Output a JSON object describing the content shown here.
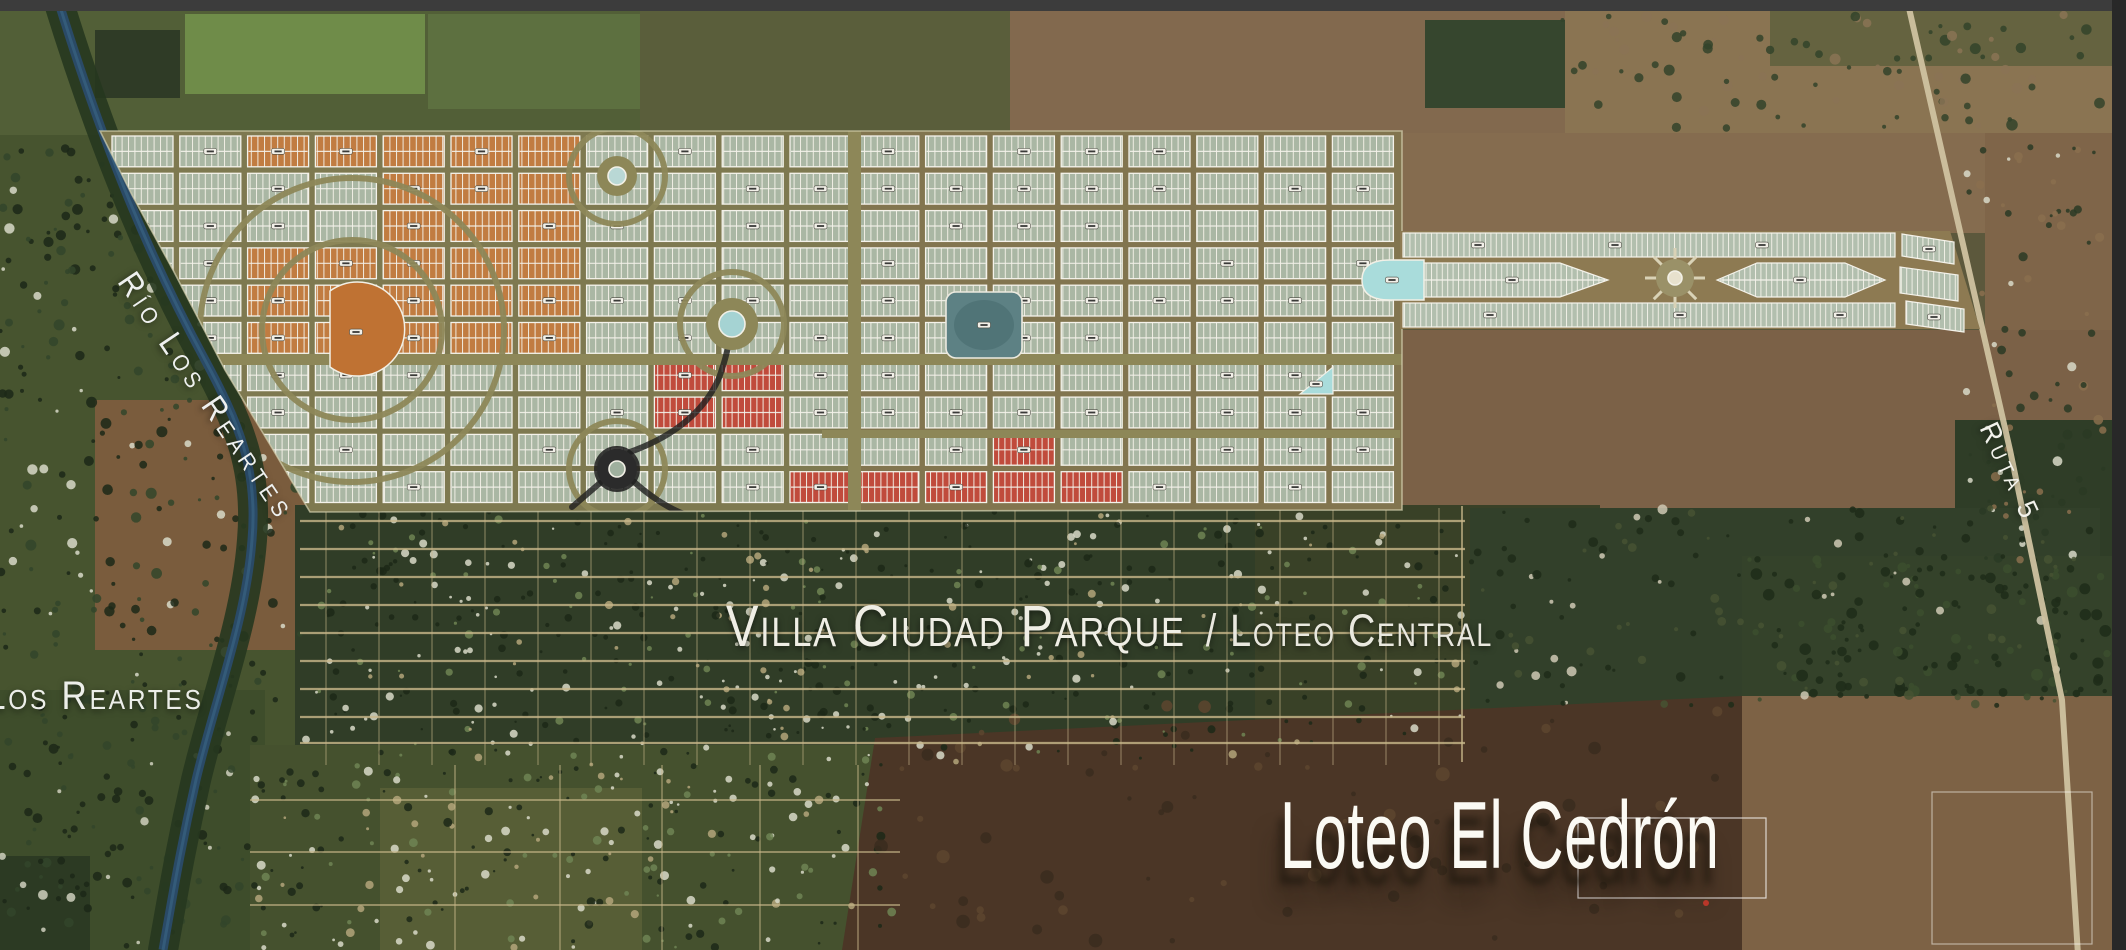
{
  "labels": {
    "villa_ciudad_parque": "Villa Ciudad Parque",
    "loteo_central_suffix": "/ Loteo Central",
    "loteo_el_cedron": "Loteo El Cedrón",
    "rio_los_reartes": "Río Los Reartes",
    "los_reartes": "Los Reartes",
    "ruta_5": "Ruta 5"
  },
  "map": {
    "width": 2126,
    "height": 950,
    "seed": 1337,
    "chrome": {
      "top_bar": {
        "h": 11,
        "fill": "#3c3c3c"
      },
      "right_bar": {
        "w": 14,
        "fill": "#282828"
      }
    },
    "fields": [
      {
        "t": "r",
        "x": 0,
        "y": 11,
        "w": 2126,
        "h": 939,
        "f": "#5c583c"
      },
      {
        "t": "r",
        "x": 0,
        "y": 11,
        "w": 660,
        "h": 124,
        "f": "#525f37"
      },
      {
        "t": "r",
        "x": 185,
        "y": 14,
        "w": 240,
        "h": 80,
        "f": "#6f8c49"
      },
      {
        "t": "r",
        "x": 428,
        "y": 14,
        "w": 215,
        "h": 95,
        "f": "#5d7040"
      },
      {
        "t": "r",
        "x": 95,
        "y": 30,
        "w": 85,
        "h": 68,
        "f": "#2f3b26"
      },
      {
        "t": "r",
        "x": 640,
        "y": 11,
        "w": 370,
        "h": 124,
        "f": "#5a5e3b"
      },
      {
        "t": "r",
        "x": 1010,
        "y": 11,
        "w": 560,
        "h": 124,
        "f": "#82694e"
      },
      {
        "t": "r",
        "x": 1425,
        "y": 20,
        "w": 140,
        "h": 88,
        "f": "#36462e"
      },
      {
        "t": "r",
        "x": 1565,
        "y": 11,
        "w": 547,
        "h": 124,
        "f": "#8a7452"
      },
      {
        "t": "r",
        "x": 1770,
        "y": 11,
        "w": 342,
        "h": 55,
        "f": "#555c39",
        "o": 0.7
      },
      {
        "t": "r",
        "x": 0,
        "y": 135,
        "w": 320,
        "h": 630,
        "f": "#47542f"
      },
      {
        "t": "r",
        "x": 95,
        "y": 400,
        "w": 235,
        "h": 250,
        "f": "#7a5c3d"
      },
      {
        "t": "r",
        "x": 0,
        "y": 690,
        "w": 265,
        "h": 260,
        "f": "#3e4d2b"
      },
      {
        "t": "r",
        "x": 1400,
        "y": 133,
        "w": 585,
        "h": 100,
        "f": "#856c4f"
      },
      {
        "t": "r",
        "x": 1985,
        "y": 133,
        "w": 127,
        "h": 430,
        "f": "#7f6549"
      },
      {
        "t": "r",
        "x": 1400,
        "y": 330,
        "w": 712,
        "h": 185,
        "f": "#7b6147"
      },
      {
        "t": "r",
        "x": 1955,
        "y": 420,
        "w": 157,
        "h": 345,
        "f": "#2f3d27"
      },
      {
        "t": "r",
        "x": 295,
        "y": 505,
        "w": 1175,
        "h": 262,
        "f": "#303d27"
      },
      {
        "t": "r",
        "x": 1255,
        "y": 505,
        "w": 345,
        "h": 258,
        "f": "#394127"
      },
      {
        "t": "r",
        "x": 1470,
        "y": 508,
        "w": 630,
        "h": 200,
        "f": "#32402a"
      },
      {
        "t": "r",
        "x": 250,
        "y": 745,
        "w": 680,
        "h": 205,
        "f": "#45512e"
      },
      {
        "t": "r",
        "x": 380,
        "y": 788,
        "w": 262,
        "h": 162,
        "f": "#575e36"
      },
      {
        "t": "p",
        "pts": "875,738 1742,696 1742,950 842,950",
        "f": "#4b3626"
      },
      {
        "t": "r",
        "x": 1742,
        "y": 690,
        "w": 370,
        "h": 260,
        "f": "#7d6245"
      },
      {
        "t": "r",
        "x": 1742,
        "y": 556,
        "w": 370,
        "h": 140,
        "f": "#34422a"
      },
      {
        "t": "r",
        "x": 0,
        "y": 856,
        "w": 90,
        "h": 94,
        "f": "#2c3a23"
      }
    ],
    "speck_groups": [
      {
        "x": 305,
        "y": 512,
        "w": 1160,
        "h": 250,
        "n": 540,
        "cols": [
          "#1c2817",
          "#d8d9c8",
          "#6f8453",
          "#b3a47a"
        ],
        "w8": [
          0.42,
          0.27,
          0.19,
          0.12
        ],
        "rmin": 1.2,
        "rmax": 4.2
      },
      {
        "x": 255,
        "y": 762,
        "w": 645,
        "h": 186,
        "n": 230,
        "cols": [
          "#1c2817",
          "#d8d9c8",
          "#6f8453",
          "#b3a47a"
        ],
        "w8": [
          0.4,
          0.25,
          0.2,
          0.15
        ],
        "rmin": 1.2,
        "rmax": 4.5
      },
      {
        "x": 0,
        "y": 140,
        "w": 300,
        "h": 560,
        "n": 260,
        "cols": [
          "#1c2817",
          "#33452a",
          "#d8d9c8"
        ],
        "w8": [
          0.5,
          0.35,
          0.15
        ],
        "rmin": 1.5,
        "rmax": 5.5
      },
      {
        "x": 0,
        "y": 700,
        "w": 260,
        "h": 248,
        "n": 120,
        "cols": [
          "#1c2817",
          "#33452a",
          "#cfd0bd"
        ],
        "w8": [
          0.5,
          0.35,
          0.15
        ],
        "rmin": 1.5,
        "rmax": 5
      },
      {
        "x": 1965,
        "y": 140,
        "w": 145,
        "h": 420,
        "n": 90,
        "cols": [
          "#2a3a24",
          "#8a6f4e",
          "#d8d9c8"
        ],
        "w8": [
          0.55,
          0.3,
          0.15
        ],
        "rmin": 1.5,
        "rmax": 5
      },
      {
        "x": 1745,
        "y": 555,
        "w": 365,
        "h": 145,
        "n": 110,
        "cols": [
          "#1e2c19",
          "#3c4d2e"
        ],
        "w8": [
          0.6,
          0.4
        ],
        "rmin": 2,
        "rmax": 6
      },
      {
        "x": 1470,
        "y": 508,
        "w": 630,
        "h": 200,
        "n": 160,
        "cols": [
          "#1e2c19",
          "#465233",
          "#cfc9b4"
        ],
        "w8": [
          0.5,
          0.35,
          0.15
        ],
        "rmin": 1.5,
        "rmax": 5
      },
      {
        "x": 1560,
        "y": 15,
        "w": 545,
        "h": 115,
        "n": 90,
        "cols": [
          "#33432a",
          "#8a7355"
        ],
        "w8": [
          0.6,
          0.4
        ],
        "rmin": 2,
        "rmax": 6
      },
      {
        "x": 875,
        "y": 700,
        "w": 860,
        "h": 245,
        "n": 70,
        "cols": [
          "#3a2b1e",
          "#5d452f"
        ],
        "w8": [
          0.55,
          0.45
        ],
        "rmin": 2,
        "rmax": 7
      }
    ],
    "river": {
      "path": "M58,0 C95,120 140,240 205,360 C240,425 258,470 252,540 C246,620 215,700 196,780 C180,850 172,900 163,950",
      "water": "#2a4a66",
      "bank": "#26371f"
    },
    "ruta5": {
      "path": "M1906,-5 L2010,450 L2062,700 L2078,955",
      "stroke": "#cfc2a0",
      "w": 6
    },
    "village": {
      "x": 300,
      "y": 508,
      "w": 1165,
      "h": 257,
      "road": "#c9b88a",
      "h_roads": [
        521,
        549,
        577,
        605,
        633,
        661,
        689,
        717,
        743
      ],
      "v_step": 53,
      "below": {
        "x": 250,
        "y": 765,
        "w": 650,
        "h": 185,
        "h_roads": [
          800,
          852,
          905
        ],
        "v_roads": [
          455,
          560,
          662,
          760,
          858
        ]
      }
    },
    "plan": {
      "clip": "100,131 1402,131 1402,510 310,512 272,448 225,370 173,270 132,195",
      "street_fill": "#7e7950",
      "east_tint": {
        "x": 855,
        "y": 131,
        "w": 547,
        "h": 379,
        "f": "#8a6f4e",
        "o": 0.38
      },
      "grid": {
        "x0": 112,
        "y0": 136,
        "x1": 1398,
        "y1": 506,
        "block_w": 61,
        "gap_x": 6.8,
        "block_h": 30.8,
        "gap_y": 6.5
      },
      "zones": {
        "orange": [
          [
            258,
            132,
            319,
            36
          ],
          [
            385,
            172,
            195,
            194
          ],
          [
            242,
            235,
            143,
            131
          ]
        ],
        "red": [
          [
            660,
            362,
            160,
            72
          ],
          [
            985,
            435,
            90,
            45
          ],
          [
            820,
            472,
            272,
            34
          ]
        ]
      },
      "block_colors": {
        "sage": "#aab7a4",
        "orange": "#c17c41",
        "red": "#c04b3c",
        "stroke": "#f4f2ea"
      },
      "avenues": [
        [
          848,
          131,
          13,
          379
        ],
        [
          100,
          354,
          1302,
          11
        ],
        [
          822,
          430,
          578,
          8
        ]
      ],
      "avenue_fill": "#8d8758",
      "arcs": [
        {
          "cx": 352,
          "cy": 330,
          "r": 90
        },
        {
          "cx": 352,
          "cy": 330,
          "r": 152
        },
        {
          "cx": 617,
          "cy": 176,
          "r": 48
        },
        {
          "cx": 732,
          "cy": 324,
          "r": 52
        },
        {
          "cx": 617,
          "cy": 469,
          "r": 48
        }
      ],
      "arc_w": 6,
      "dark": {
        "stroke": "#1f1f1f",
        "paths": [
          "M600,483 L572,507",
          "M633,481 Q660,505 684,514",
          "M630,452 Q697,428 719,378 Q729,350 731,328"
        ],
        "ring": {
          "cx": 617,
          "cy": 469,
          "r": 19,
          "w": 8
        }
      },
      "roundabouts": [
        {
          "cx": 617,
          "cy": 176,
          "r": 20,
          "ring": "#8d8758",
          "core": "#b9d8d5",
          "core_r": 9
        },
        {
          "cx": 732,
          "cy": 324,
          "r": 26,
          "ring": "#8d8758",
          "core": "#a5d3d3",
          "core_r": 13
        },
        {
          "cx": 617,
          "cy": 469,
          "r": 20,
          "ring": "#2b2b2b",
          "core": "#9fb09e",
          "core_r": 8
        },
        {
          "cx": 1675,
          "cy": 278,
          "r": 19,
          "ring": "#9a9168",
          "core": "#e7e1cd",
          "core_r": 7,
          "spokes": 8
        }
      ],
      "plazas": {
        "orange_half_disc": {
          "d": "M330,291 A47,47 0 1 1 330,367 Z",
          "f": "#bf7233"
        },
        "teal_square": {
          "x": 946,
          "y": 292,
          "w": 76,
          "h": 66,
          "rx": 10,
          "f": "#5d8184",
          "inner": "#4e7174"
        },
        "cyan_stadium": {
          "d": "M1424,260 L1390,260 Q1362,260 1362,280 Q1362,300 1390,300 L1424,300 Z",
          "f": "#a9dcdb"
        },
        "cyan_triangle": {
          "pts": "1300,394 1333,394 1333,367",
          "f": "#a9dcdb"
        }
      },
      "arm": {
        "base": {
          "pts": "1400,231 1950,231 1980,329 1400,329",
          "f": "#8d7a52"
        },
        "bands": [
          {
            "t": "r",
            "x": 1403,
            "y": 233,
            "w": 492,
            "h": 24
          },
          {
            "t": "p",
            "pts": "1403,263 1560,263 1608,280 1560,297 1403,297",
            "mid": 280
          },
          {
            "t": "p",
            "pts": "1717,280 1757,263 1845,263 1885,280 1845,297 1757,297",
            "mid": 280
          },
          {
            "t": "r",
            "x": 1403,
            "y": 303,
            "w": 492,
            "h": 24
          },
          {
            "t": "r",
            "x": 1902,
            "y": 234,
            "w": 52,
            "h": 22,
            "skew": true
          },
          {
            "t": "r",
            "x": 1900,
            "y": 267,
            "w": 58,
            "h": 26,
            "skew": true
          },
          {
            "t": "r",
            "x": 1906,
            "y": 301,
            "w": 58,
            "h": 23,
            "skew": true
          }
        ],
        "lot_color": "#b2bfae",
        "stroke": "#f4f2ea"
      },
      "pill": {
        "f": "#f2f0e8",
        "stroke": "#4a4a42",
        "dash": "#3a3a38"
      },
      "pill_points": [
        [
          1478,
          245
        ],
        [
          1615,
          245
        ],
        [
          1762,
          245
        ],
        [
          1512,
          280
        ],
        [
          1800,
          280
        ],
        [
          1490,
          315
        ],
        [
          1680,
          315
        ],
        [
          1840,
          315
        ],
        [
          1929,
          249
        ],
        [
          1934,
          317
        ],
        [
          984,
          325
        ],
        [
          1392,
          280
        ],
        [
          356,
          332
        ],
        [
          1316,
          384
        ]
      ],
      "boundary_stroke": "#d6d2b0"
    },
    "extras": {
      "white_field_outlines": [
        {
          "x": 1578,
          "y": 818,
          "w": 188,
          "h": 80,
          "o": 0.75
        },
        {
          "x": 1932,
          "y": 792,
          "w": 160,
          "h": 152,
          "o": 0.5
        }
      ],
      "red_dot": {
        "cx": 1706,
        "cy": 903,
        "r": 3
      },
      "village_edge_road": {
        "x1": 1462,
        "y1": 506,
        "x2": 1462,
        "y2": 762
      }
    }
  }
}
